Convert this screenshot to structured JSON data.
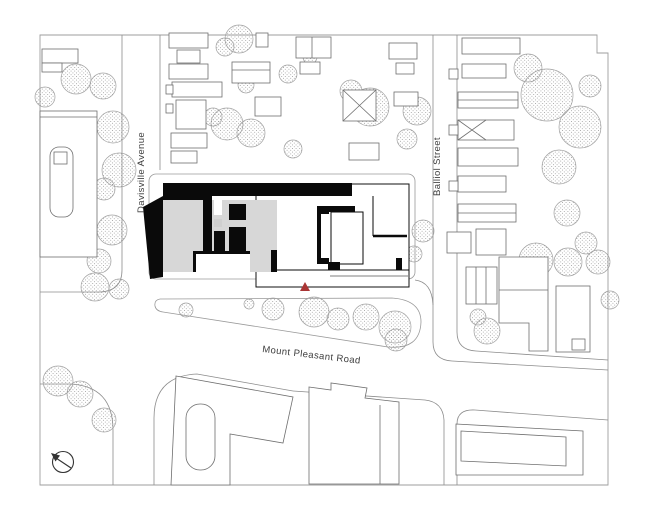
{
  "streets": {
    "davisville": "Davisville Avenue",
    "balliol": "Balliol Street",
    "mount_pleasant": "Mount Pleasant Road"
  },
  "marker": {
    "icon": "site-location-triangle-icon",
    "color": "#a93534"
  },
  "north_arrow": {
    "icon": "north-arrow-compass-icon"
  },
  "colors": {
    "subject_building": "#0a0a0a",
    "subject_floor_gray": "#d7d7d7",
    "context_line": "#8c8c8c",
    "frame_line": "#9e9e9e",
    "background": "#ffffff"
  }
}
